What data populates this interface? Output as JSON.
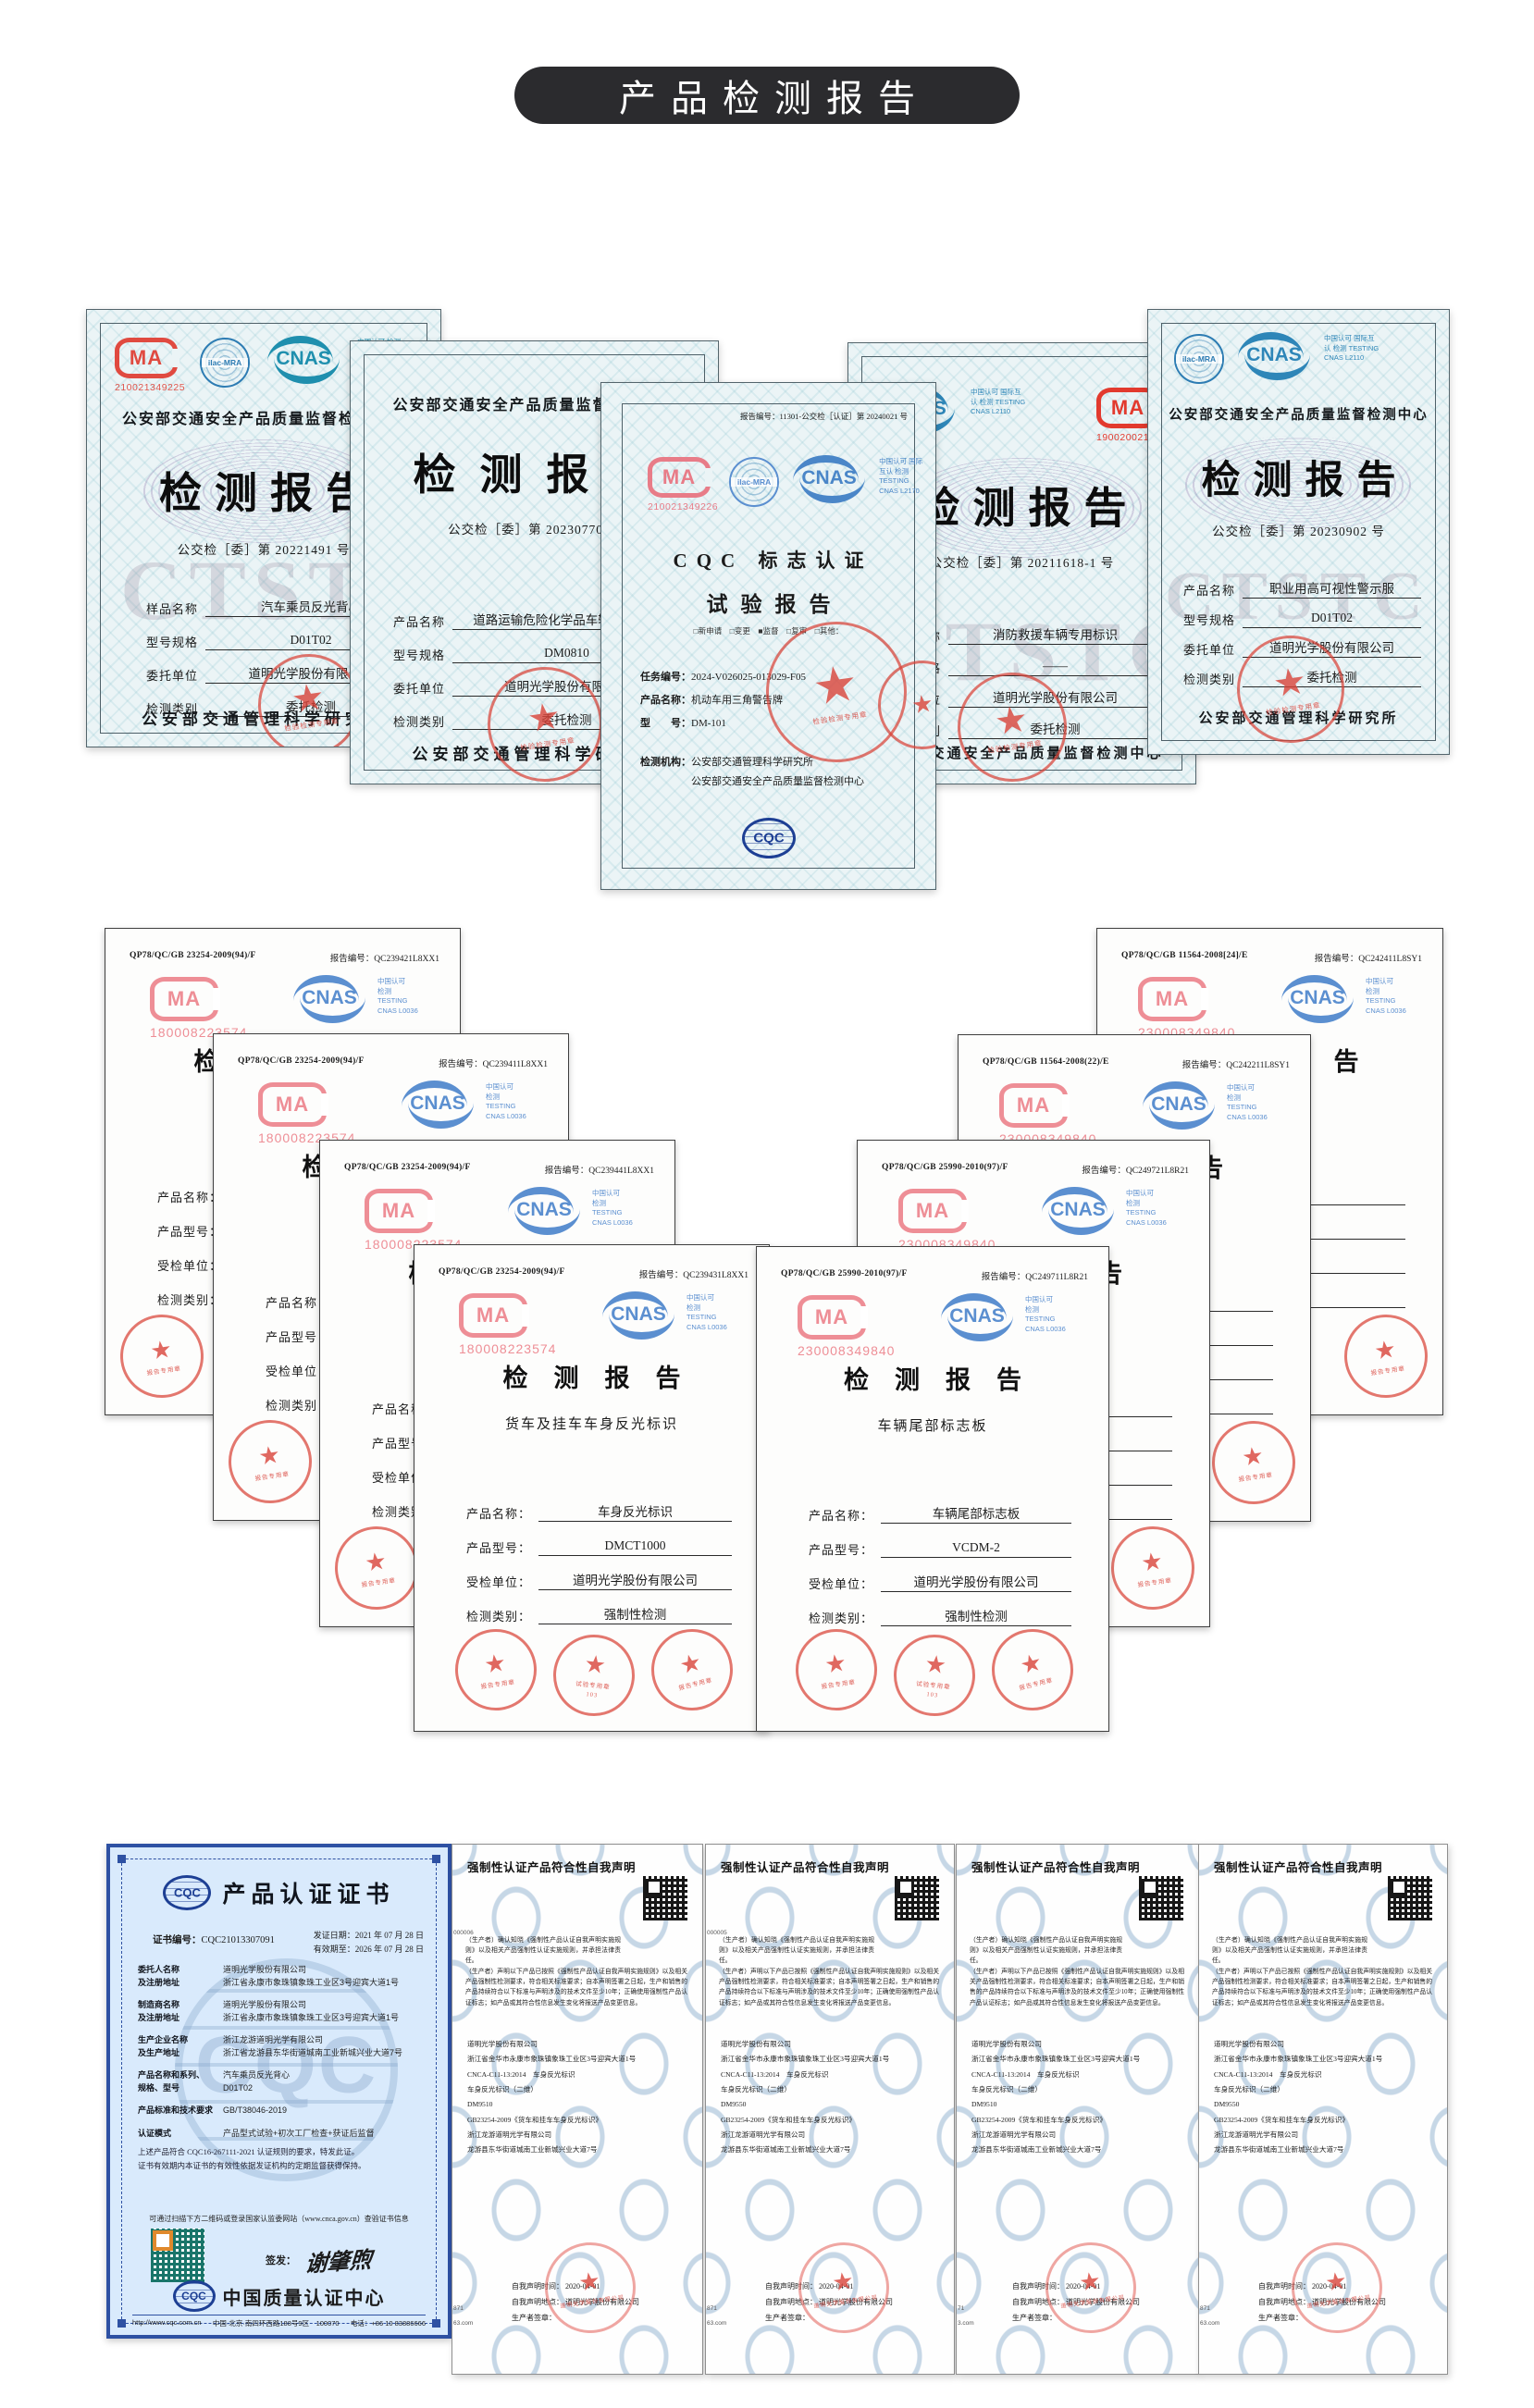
{
  "banner": {
    "title": "产品检测报告"
  },
  "logos": {
    "cma": "MA",
    "cnas": "CNAS",
    "ilac": "ilac-MRA",
    "cqc": "CQC"
  },
  "row1": {
    "cert1": {
      "cma_code": "210021349225",
      "cnas_side": "中国认可 检测 TESTING",
      "header": "公安部交通安全产品质量监督检验中心",
      "title": "检测报告",
      "report_no": "公交检［委］第 20221491 号",
      "fields": [
        {
          "label": "样品名称",
          "value": "汽车乘员反光背心"
        },
        {
          "label": "型号规格",
          "value": "D01T02"
        },
        {
          "label": "委托单位",
          "value": "道明光学股份有限公司"
        },
        {
          "label": "检测类别",
          "value": "委托检测"
        }
      ],
      "footer": "公安部交通管理科学研究所",
      "stamp": "检验检测专用章",
      "watermark": "CTST"
    },
    "cert2": {
      "header": "公安部交通安全产品质量监督检验中心",
      "title": "检测报告",
      "report_no": "公交检［委］第 20230770 号",
      "fields": [
        {
          "label": "产品名称",
          "value": "道路运输危险化学品车辆警示标牌"
        },
        {
          "label": "型号规格",
          "value": "DM0810"
        },
        {
          "label": "委托单位",
          "value": "道明光学股份有限公司"
        },
        {
          "label": "检测类别",
          "value": "委托检测"
        }
      ],
      "footer": "公安部交通管理科学研究所",
      "stamp": "检验检测专用章"
    },
    "cert3": {
      "report_no": "报告编号：11301-公交检［认证］第 20240021 号",
      "cma_code": "210021349226",
      "cnas_side": "中国认可 国际互认 检测 TESTING CNAS L2170",
      "title1": "CQC 标志认证",
      "title2": "试验报告",
      "checks": "□新申请　□变更　■监督　□复审　□其他：",
      "task_label": "任务编号：",
      "task": "2024-V026025-013029-F05",
      "product_label": "产品名称：",
      "product": "机动车用三角警告牌",
      "model_label": "型　　号：",
      "model": "DM-101",
      "agency_label": "检测机构：",
      "agency1": "公安部交通管理科学研究所",
      "agency2": "公安部交通安全产品质量监督检测中心",
      "stamp": "检验检测专用章"
    },
    "cert4": {
      "cnas_side": "中国认可 国际互认 检测 TESTING CNAS L2110",
      "cma_code": "190020021432",
      "title": "检测报告",
      "report_no": "公交检［委］第 20211618-1 号",
      "fields": [
        {
          "label": "产品名称",
          "value": "消防救援车辆专用标识"
        },
        {
          "label": "型号规格",
          "value": "——"
        },
        {
          "label": "委托单位",
          "value": "道明光学股份有限公司"
        },
        {
          "label": "检测类别",
          "value": "委托检测"
        }
      ],
      "footer": "公安部交通安全产品质量监督检测中心",
      "stamp": "检验检测专用章",
      "watermark": "CTSTC"
    },
    "cert5": {
      "cnas_side": "中国认可 国际互认 检测 TESTING CNAS L2110",
      "header": "公安部交通安全产品质量监督检测中心",
      "title": "检测报告",
      "report_no": "公交检［委］第 20230902 号",
      "fields": [
        {
          "label": "产品名称",
          "value": "职业用高可视性警示服"
        },
        {
          "label": "型号规格",
          "value": "D01T02"
        },
        {
          "label": "委托单位",
          "value": "道明光学股份有限公司"
        },
        {
          "label": "检测类别",
          "value": "委托检测"
        }
      ],
      "footer": "公安部交通管理科学研究所",
      "stamp": "检验检测专用章",
      "watermark": "CTSTC"
    }
  },
  "row2": {
    "report_label": "报告编号：",
    "cnas_side1": "中国认可",
    "cnas_side2": "检测",
    "cnas_side3": "TESTING",
    "cnas_side4": "CNAS L0036",
    "field_labels": [
      "产品名称：",
      "产品型号：",
      "受检单位：",
      "检测类别："
    ],
    "stamp_report": "报告专用章",
    "stamp_test": "试验专用章",
    "stamp_no": "103",
    "left_stack": [
      {
        "std": "QP78/QC/GB 23254-2009(94)/F",
        "report": "QC239421L8XX1",
        "cma_code": "180008223574"
      },
      {
        "std": "QP78/QC/GB 23254-2009(94)/F",
        "report": "QC239411L8XX1",
        "cma_code": "180008223574"
      },
      {
        "std": "QP78/QC/GB 23254-2009(94)/F",
        "report": "QC239441L8XX1",
        "cma_code": "180008223574"
      }
    ],
    "front_left": {
      "std": "QP78/QC/GB 23254-2009(94)/F",
      "report": "QC239431L8XX1",
      "cma_code": "180008223574",
      "title": "检测报告",
      "subtitle": "货车及挂车车身反光标识",
      "fields": [
        {
          "label": "产品名称：",
          "value": "车身反光标识"
        },
        {
          "label": "产品型号：",
          "value": "DMCT1000"
        },
        {
          "label": "受检单位：",
          "value": "道明光学股份有限公司"
        },
        {
          "label": "检测类别：",
          "value": "强制性检测"
        }
      ]
    },
    "right_stack": [
      {
        "std": "QP78/QC/GB 11564-2008[24]/E",
        "report": "QC242411L8SY1",
        "cma_code": "230008349840"
      },
      {
        "std": "QP78/QC/GB 11564-2008(22)/E",
        "report": "QC242211L8SY1",
        "cma_code": "230008349840"
      },
      {
        "std": "QP78/QC/GB 25990-2010(97)/F",
        "report": "QC249721L8R21",
        "cma_code": "230008349840"
      }
    ],
    "front_right": {
      "std": "QP78/QC/GB 25990-2010(97)/F",
      "report": "QC249711L8R21",
      "cma_code": "230008349840",
      "title": "检测报告",
      "subtitle": "车辆尾部标志板",
      "fields": [
        {
          "label": "产品名称：",
          "value": "车辆尾部标志板"
        },
        {
          "label": "产品型号：",
          "value": "VCDM-2"
        },
        {
          "label": "受检单位：",
          "value": "道明光学股份有限公司"
        },
        {
          "label": "检测类别：",
          "value": "强制性检测"
        }
      ]
    }
  },
  "row3": {
    "cqc": {
      "title": "产品认证证书",
      "no_label": "证书编号：",
      "no": "CQC21013307091",
      "issue": "发证日期：2021 年 07 月 28 日",
      "valid": "有效期至：2026 年 07 月 28 日",
      "rows": [
        {
          "l1": "委托人名称",
          "l2": "及注册地址",
          "v1": "道明光学股份有限公司",
          "v2": "浙江省永康市象珠镇象珠工业区3号迎宾大道1号"
        },
        {
          "l1": "制造商名称",
          "l2": "及注册地址",
          "v1": "道明光学股份有限公司",
          "v2": "浙江省永康市象珠镇象珠工业区3号迎宾大道1号"
        },
        {
          "l1": "生产企业名称",
          "l2": "及生产地址",
          "v1": "浙江龙游道明光学有限公司",
          "v2": "浙江省龙游县东华街道城南工业新城兴业大道7号"
        },
        {
          "l1": "产品名称和系列、",
          "l2": "规格、型号",
          "v1": "汽车乘员反光背心",
          "v2": "D01T02"
        },
        {
          "l1": "产品标准和技术要求",
          "l2": "",
          "v1": "GB/T38046-2019",
          "v2": ""
        },
        {
          "l1": "认证模式",
          "l2": "",
          "v1": "产品型式试验+初次工厂检查+获证后监督",
          "v2": ""
        }
      ],
      "note1": "上述产品符合 CQC16-267111-2021 认证规则的要求，特发此证。",
      "note2": "证书有效期内本证书的有效性依据发证机构的定期监督获得保持。",
      "qr_hint": "可通过扫描下方二维码或登录国家认监委网站（www.cnca.gov.cn）查验证书信息",
      "sign_label": "签发：",
      "signature": "谢肇煦",
      "org": "中国质量认证中心",
      "footer_url": "http://www.cqc.com.cn",
      "footer_addr": "中国·北京·南四环西路188号9区　100070",
      "footer_tel": "电话：+86 10 83886666"
    },
    "declarations": [
      {
        "title": "强制性认证产品符合性自我声明",
        "para1": "（生产者）确认知晓《强制性产品认证自我声明实施规则》以及相关产品强制性认证实施规则，并承担法律责任。",
        "para2": "（生产者）声明以下产品已按照《强制性产品认证自我声明实施规则》以及相关产品强制性检测要求，符合相关标准要求；自本声明签署之日起，生产和销售的产品持续符合以下标准与声明涉及的技术文件至少10年；正确使用强制性产品认证标志；如产品或其符合性信息发生变化将报送产品变更信息。",
        "lines": [
          "道明光学股份有限公司",
          "浙江省金华市永康市象珠镇象珠工业区3号迎宾大道1号",
          "CNCA-C11-13:2014　车身反光标识",
          "车身反光标识（二维）",
          "DM9510",
          "GB23254-2009《货车和挂车车身反光标识》",
          "浙江龙游道明光学有限公司",
          "龙游县东华街道城南工业新城兴业大道7号"
        ],
        "time": "自我声明时间：  2020-04-01",
        "place": "自我声明地点：  道明光学股份有限公司",
        "sign": "生产者签章：",
        "stamp_text": "道明光学股份有限公司",
        "edge_top": "000006",
        "edge_b1": "871",
        "edge_b2": "63.com"
      },
      {
        "title": "强制性认证产品符合性自我声明",
        "para1": "（生产者）确认知晓《强制性产品认证自我声明实施规则》以及相关产品强制性认证实施规则，并承担法律责任。",
        "para2": "（生产者）声明以下产品已按照《强制性产品认证自我声明实施规则》以及相关产品强制性检测要求，符合相关标准要求；自本声明签署之日起，生产和销售的产品持续符合以下标准与声明涉及的技术文件至少10年；正确使用强制性产品认证标志；如产品或其符合性信息发生变化将报送产品变更信息。",
        "lines": [
          "道明光学股份有限公司",
          "浙江省金华市永康市象珠镇象珠工业区3号迎宾大道1号",
          "CNCA-C11-13:2014　车身反光标识",
          "车身反光标识（二维）",
          "DM9550",
          "GB23254-2009《货车和挂车车身反光标识》",
          "浙江龙游道明光学有限公司",
          "龙游县东华街道城南工业新城兴业大道7号"
        ],
        "time": "自我声明时间：  2020-04-01",
        "place": "自我声明地点：  道明光学股份有限公司",
        "sign": "生产者签章：",
        "stamp_text": "道明光学股份有限公司",
        "edge_top": "000005",
        "edge_b1": "871",
        "edge_b2": "63.com"
      },
      {
        "title": "强制性认证产品符合性自我声明",
        "para1": "（生产者）确认知晓《强制性产品认证自我声明实施规则》以及相关产品强制性认证实施规则，并承担法律责任。",
        "para2": "（生产者）声明以下产品已按照《强制性产品认证自我声明实施规则》以及相关产品强制性检测要求，符合相关标准要求；自本声明签署之日起，生产和销售的产品持续符合以下标准与声明涉及的技术文件至少10年；正确使用强制性产品认证标志；如产品或其符合性信息发生变化将报送产品变更信息。",
        "lines": [
          "道明光学股份有限公司",
          "浙江省金华市永康市象珠镇象珠工业区3号迎宾大道1号",
          "CNCA-C11-13:2014　车身反光标识",
          "车身反光标识（二维）",
          "DM9510",
          "GB23254-2009《货车和挂车车身反光标识》",
          "浙江龙游道明光学有限公司",
          "龙游县东华街道城南工业新城兴业大道7号"
        ],
        "time": "自我声明时间：  2020-04-01",
        "place": "自我声明地点：  道明光学股份有限公司",
        "sign": "生产者签章：",
        "stamp_text": "道明光学股份有限公司",
        "edge_top": "",
        "edge_b1": "71",
        "edge_b2": "3.com"
      },
      {
        "title": "强制性认证产品符合性自我声明",
        "para1": "（生产者）确认知晓《强制性产品认证自我声明实施规则》以及相关产品强制性认证实施规则，并承担法律责任。",
        "para2": "（生产者）声明以下产品已按照《强制性产品认证自我声明实施规则》以及相关产品强制性检测要求，符合相关标准要求；自本声明签署之日起，生产和销售的产品持续符合以下标准与声明涉及的技术文件至少10年；正确使用强制性产品认证标志；如产品或其符合性信息发生变化将报送产品变更信息。",
        "lines": [
          "道明光学股份有限公司",
          "浙江省金华市永康市象珠镇象珠工业区3号迎宾大道1号",
          "CNCA-C11-13:2014　车身反光标识",
          "车身反光标识（二维）",
          "DM9550",
          "GB23254-2009《货车和挂车车身反光标识》",
          "浙江龙游道明光学有限公司",
          "龙游县东华街道城南工业新城兴业大道7号"
        ],
        "time": "自我声明时间：  2020-04-01",
        "place": "自我声明地点：  道明光学股份有限公司",
        "sign": "生产者签章：",
        "stamp_text": "道明光学股份有限公司",
        "edge_top": "",
        "edge_b1": "871",
        "edge_b2": "63.com"
      }
    ]
  }
}
